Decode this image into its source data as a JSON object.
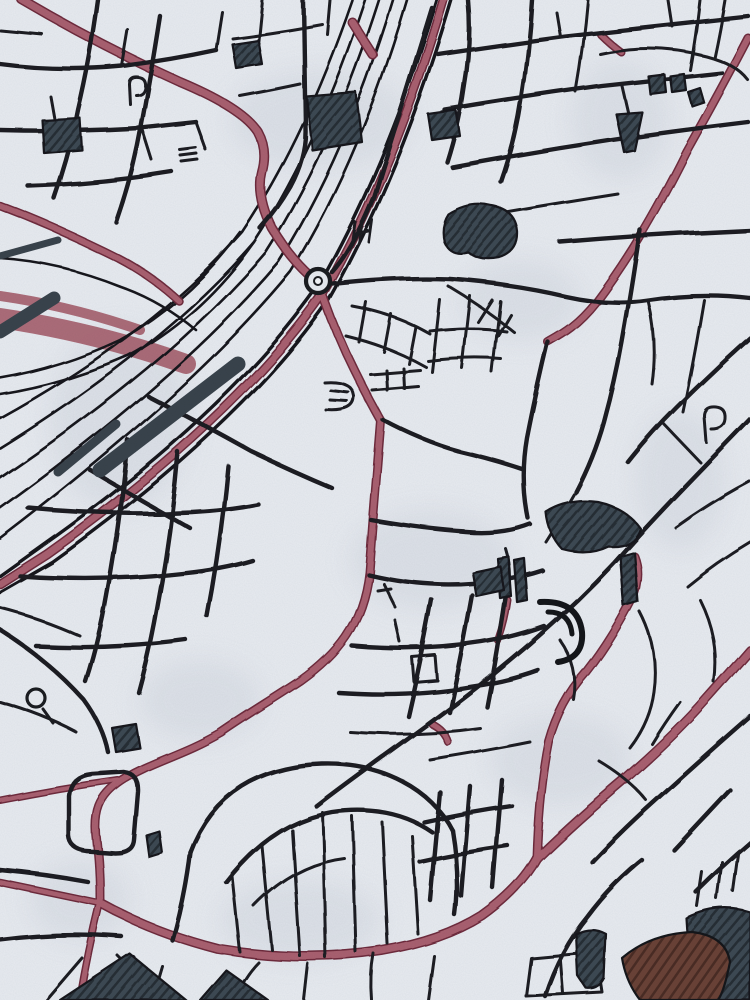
{
  "artwork": {
    "title": "watercolor-ink-city-street-map-art",
    "palette": {
      "paper": "#e8ebf0",
      "paper_shadow": "#bcc5d0",
      "ink": "#1a1c20",
      "rail_ink": "#17191d",
      "accent_road_fill": "#a9606f",
      "accent_road_casing": "#6e2c3c",
      "yard_red": "#a35a68",
      "dark_block": "#3d4852",
      "dark_block_hatch": "#252e36",
      "brown_block": "#6a4237",
      "brown_block_hatch": "#4a2c24"
    },
    "layers": [
      {
        "name": "paper-blotches",
        "kind": "ellipse",
        "fill": "#bcc5d0",
        "opacity": 0.26,
        "blur": true,
        "items": [
          {
            "cx": 320,
            "cy": 120,
            "rx": 90,
            "ry": 50
          },
          {
            "cx": 120,
            "cy": 420,
            "rx": 70,
            "ry": 90
          },
          {
            "cx": 520,
            "cy": 300,
            "rx": 60,
            "ry": 40
          },
          {
            "cx": 620,
            "cy": 120,
            "rx": 50,
            "ry": 60
          },
          {
            "cx": 430,
            "cy": 560,
            "rx": 80,
            "ry": 50
          },
          {
            "cx": 200,
            "cy": 700,
            "rx": 60,
            "ry": 40
          },
          {
            "cx": 560,
            "cy": 760,
            "rx": 70,
            "ry": 45
          },
          {
            "cx": 300,
            "cy": 920,
            "rx": 80,
            "ry": 40
          },
          {
            "cx": 680,
            "cy": 480,
            "rx": 45,
            "ry": 70
          },
          {
            "cx": 80,
            "cy": 900,
            "rx": 50,
            "ry": 40
          }
        ]
      },
      {
        "name": "railway-yard-red-band",
        "kind": "path",
        "stroke": "#a35a68",
        "opacity": 0.88,
        "items": [
          {
            "d": "M0,318 Q95,332 186,364",
            "w": 20
          },
          {
            "d": "M0,296 Q70,306 140,330",
            "w": 10
          }
        ]
      },
      {
        "name": "railway-tracks",
        "kind": "path",
        "stroke": "#17191d",
        "width": 2.6,
        "rough": true,
        "items": [
          {
            "d": "M352,0 Q304,140 242,232 Q152,334 0,418"
          },
          {
            "d": "M365,0 Q317,146 254,242 Q162,348 0,448"
          },
          {
            "d": "M379,0 Q331,151 266,252 Q172,362 0,478"
          },
          {
            "d": "M393,0 Q346,156 279,262 Q182,377 0,508"
          },
          {
            "d": "M407,0 Q360,161 291,272 Q192,392 0,538"
          },
          {
            "d": "M240,232 Q190,300 120,340 Q60,368 0,378"
          },
          {
            "d": "M254,242 Q200,318 128,356 Q64,384 0,394"
          },
          {
            "d": "M0,258 Q60,262 120,286 Q160,300 196,330"
          }
        ]
      },
      {
        "name": "highway-lines",
        "kind": "path",
        "stroke": "#17191d",
        "width": 3.4,
        "rough": true,
        "items": [
          {
            "d": "M437,0 Q386,170 316,290 Q226,416 42,546 L0,576"
          },
          {
            "d": "M452,0 Q400,176 328,302 Q240,428 52,562 L0,592"
          }
        ]
      },
      {
        "name": "red-roads",
        "kind": "path",
        "stroke": "#a9606f",
        "casing": {
          "stroke": "#6e2c3c",
          "extra": 3
        },
        "rough": true,
        "items": [
          {
            "d": "M444,0 Q393,173 322,296 Q233,422 47,554 L0,584",
            "w": 6.5
          },
          {
            "d": "M22,0 Q100,46 180,82 Q242,108 258,132 Q268,150 262,172 Q256,196 272,228 Q290,258 310,276",
            "w": 7
          },
          {
            "d": "M0,206 Q58,228 118,258 Q152,276 178,300",
            "w": 5.5
          },
          {
            "d": "M748,38 C722,88 704,120 686,152 C652,220 626,262 596,302 C577,326 562,334 548,342",
            "w": 6
          },
          {
            "d": "M100,903 Q152,932 218,949 Q302,963 382,951 Q442,941 482,916 Q520,889 537,858",
            "w": 7
          },
          {
            "d": "M537,858 Q576,820 626,778 Q676,734 706,700 Q731,672 750,650",
            "w": 7
          },
          {
            "d": "M100,903 Q58,894 0,882",
            "w": 4.5
          },
          {
            "d": "M100,903 Q88,952 80,1000",
            "w": 5
          },
          {
            "d": "M634,556 Q642,576 631,602 Q611,641 586,673 Q560,702 549,742 Q539,792 537,858",
            "w": 6
          },
          {
            "d": "M318,281 Q331,320 346,353 Q363,389 381,421",
            "w": 6
          },
          {
            "d": "M381,421 C376,480 373,520 369,572 C363,626 336,656 301,681 C271,701 250,713 221,733 C181,756 150,762 121,781 C99,796 93,812 97,843 C100,870 100,888 100,903",
            "w": 6
          },
          {
            "d": "M118,780 Q60,788 0,800",
            "w": 4
          },
          {
            "d": "M352,22 Q362,38 373,55",
            "w": 7
          },
          {
            "d": "M600,34 Q610,44 621,52",
            "w": 5
          },
          {
            "d": "M508,600 Q505,622 498,641",
            "w": 4
          },
          {
            "d": "M432,724 Q444,730 448,742",
            "w": 5
          }
        ]
      },
      {
        "name": "streets-major",
        "kind": "path",
        "stroke": "#1a1c20",
        "width": 4.4,
        "rough": true,
        "items": [
          {
            "d": "M98,0 Q90,60 78,110 Q70,152 54,198"
          },
          {
            "d": "M160,16 Q150,80 140,132 Q132,176 116,222"
          },
          {
            "d": "M0,64 Q60,72 122,66 Q170,60 216,50"
          },
          {
            "d": "M0,130 Q70,132 140,128 L196,122"
          },
          {
            "d": "M28,186 Q100,184 172,172"
          },
          {
            "d": "M303,0 L305,128 Q306,156 290,186 Q276,210 260,228"
          },
          {
            "d": "M432,8 Q405,95 374,196 Q352,250 332,272"
          },
          {
            "d": "M438,54 Q505,44 565,36 Q655,26 748,16"
          },
          {
            "d": "M445,110 Q522,97 602,86 Q665,79 722,73"
          },
          {
            "d": "M452,167 Q532,152 612,140 Q682,130 748,122"
          },
          {
            "d": "M468,0 Q472,42 464,88 Q459,124 447,162"
          },
          {
            "d": "M532,0 Q529,52 521,102 Q515,142 501,182"
          },
          {
            "d": "M560,242 Q655,234 750,230"
          },
          {
            "d": "M333,284 Q395,277 450,279 Q515,284 565,296 Q610,306 648,300 Q700,292 750,298"
          },
          {
            "d": "M548,342 Q536,392 527,438 Q520,478 528,518"
          },
          {
            "d": "M640,230 Q631,292 622,342 Q615,382 604,422 Q594,458 576,492"
          },
          {
            "d": "M750,418 C700,470 658,512 614,562 C558,622 498,672 438,716 C395,748 352,778 316,806"
          },
          {
            "d": "M750,338 Q712,372 676,408 Q650,434 628,462"
          },
          {
            "d": "M148,396 Q202,424 252,452 Q294,472 332,488"
          },
          {
            "d": "M128,440 Q121,522 107,596 Q99,642 86,682"
          },
          {
            "d": "M178,452 Q171,532 157,606 Q149,652 138,692"
          },
          {
            "d": "M228,466 Q221,542 207,616"
          },
          {
            "d": "M28,508 Q112,516 192,512 Q228,510 258,504"
          },
          {
            "d": "M20,576 Q102,582 182,573 Q222,569 252,560"
          },
          {
            "d": "M36,646 Q112,650 186,640"
          },
          {
            "d": "M0,630 Q48,660 84,700 Q103,726 108,752"
          },
          {
            "d": "M383,420 Q422,441 458,451 Q492,459 522,469"
          },
          {
            "d": "M371,520 Q422,529 466,532 Q502,535 530,524"
          },
          {
            "d": "M368,574 Q422,587 472,583 Q512,580 542,570"
          },
          {
            "d": "M352,646 Q420,652 482,642 Q514,637 544,626"
          },
          {
            "d": "M338,692 Q410,697 472,686 Q508,681 538,670"
          },
          {
            "d": "M432,600 Q421,660 408,716"
          },
          {
            "d": "M472,595 Q461,656 449,712"
          },
          {
            "d": "M507,588 Q498,650 487,707"
          },
          {
            "d": "M190,852 C212,792 262,766 322,764 C382,762 432,790 452,830"
          },
          {
            "d": "M226,882 Q272,822 332,812 Q392,804 432,832"
          },
          {
            "d": "M190,852 Q184,900 172,940"
          },
          {
            "d": "M452,830 Q460,878 455,915"
          },
          {
            "d": "M440,792 L430,900"
          },
          {
            "d": "M470,786 L461,896"
          },
          {
            "d": "M502,780 L493,888"
          },
          {
            "d": "M424,822 Q468,812 512,806"
          },
          {
            "d": "M420,862 Q464,852 508,846"
          },
          {
            "d": "M750,716 Q702,758 658,798 Q622,830 592,862"
          },
          {
            "d": "M730,790 Q702,820 674,850"
          },
          {
            "d": "M750,842 Q722,866 696,892"
          },
          {
            "d": "M545,996 Q560,950 588,916 Q612,884 642,860"
          },
          {
            "d": "M642,1000 Q662,960 696,930"
          },
          {
            "d": "M69,796 Q71,776 92,774 L124,772 Q139,774 138,792 L134,840 Q133,853 115,853 L86,851 Q70,849 69,836 Z"
          },
          {
            "d": "M0,870 Q45,874 88,882"
          },
          {
            "d": "M0,940 Q60,932 122,937"
          },
          {
            "d": "M90,470 Q140,500 190,528"
          }
        ]
      },
      {
        "name": "streets-minor",
        "kind": "path",
        "stroke": "#1a1c20",
        "width": 3,
        "rough": true,
        "items": [
          {
            "d": "M122,66 L128,30"
          },
          {
            "d": "M56,130 L50,96"
          },
          {
            "d": "M142,128 L152,160"
          },
          {
            "d": "M0,30 L42,34"
          },
          {
            "d": "M216,50 L222,12"
          },
          {
            "d": "M196,122 L206,150"
          },
          {
            "d": "M262,0 L258,40"
          },
          {
            "d": "M232,38 Q280,32 322,24"
          },
          {
            "d": "M240,96 Q272,90 300,84"
          },
          {
            "d": "M330,0 L327,34"
          },
          {
            "d": "M560,36 L556,12"
          },
          {
            "d": "M622,86 L628,112"
          },
          {
            "d": "M672,26 L668,0"
          },
          {
            "d": "M700,0 Q696,36 690,70"
          },
          {
            "d": "M725,0 Q720,30 714,58"
          },
          {
            "d": "M588,0 Q584,46 576,92"
          },
          {
            "d": "M600,54 Q652,42 706,56 Q736,64 748,80"
          },
          {
            "d": "M462,220 Q542,206 618,194"
          },
          {
            "d": "M352,306 Q396,314 430,334"
          },
          {
            "d": "M346,336 Q391,347 426,367"
          },
          {
            "d": "M366,302 L359,342"
          },
          {
            "d": "M391,314 L384,352"
          },
          {
            "d": "M416,327 L409,364"
          },
          {
            "d": "M440,300 L432,372"
          },
          {
            "d": "M470,296 L462,368"
          },
          {
            "d": "M500,301 L492,372"
          },
          {
            "d": "M430,331 Q470,326 506,331"
          },
          {
            "d": "M428,361 Q468,356 501,359"
          },
          {
            "d": "M370,374 L420,370"
          },
          {
            "d": "M372,390 L418,386"
          },
          {
            "d": "M386,370 L387,390"
          },
          {
            "d": "M403,368 L404,388"
          },
          {
            "d": "M324,382 Q352,380 354,396 Q355,412 326,410"
          },
          {
            "d": "M330,390 L348,392"
          },
          {
            "d": "M330,400 L347,401"
          },
          {
            "d": "M448,286 Q482,306 514,332"
          },
          {
            "d": "M492,300 L478,322"
          },
          {
            "d": "M510,314 L497,336"
          },
          {
            "d": "M704,300 Q694,360 683,412"
          },
          {
            "d": "M750,482 Q712,502 676,528"
          },
          {
            "d": "M750,542 Q716,562 687,586"
          },
          {
            "d": "M706,442 L704,416 Q704,406 716,407 Q726,408 725,419 Q724,429 711,429"
          },
          {
            "d": "M662,422 L700,462"
          },
          {
            "d": "M412,657 L414,682 L437,680 L435,655 Z"
          },
          {
            "d": "M395,620 L400,642"
          },
          {
            "d": "M350,732 Q418,737 480,728"
          },
          {
            "d": "M383,583 L395,607"
          },
          {
            "d": "M377,590 L390,588"
          },
          {
            "d": "M355,222 L352,244"
          },
          {
            "d": "M362,222 L359,244"
          },
          {
            "d": "M359,233 L368,231"
          },
          {
            "d": "M372,220 L369,242"
          },
          {
            "d": "M44,710 L54,724"
          },
          {
            "d": "M0,702 Q42,714 76,732"
          },
          {
            "d": "M232,876 L240,952"
          },
          {
            "d": "M262,846 L272,950"
          },
          {
            "d": "M292,830 L300,956"
          },
          {
            "d": "M322,812 L326,958"
          },
          {
            "d": "M352,816 L356,952"
          },
          {
            "d": "M382,822 L388,944"
          },
          {
            "d": "M412,836 L418,934"
          },
          {
            "d": "M254,906 Q294,864 344,858"
          },
          {
            "d": "M46,1000 L82,958"
          },
          {
            "d": "M152,1000 L162,966"
          },
          {
            "d": "M234,1000 Q244,976 258,962"
          },
          {
            "d": "M304,1000 L308,964"
          },
          {
            "d": "M372,1000 Q370,976 374,954"
          },
          {
            "d": "M428,1000 L434,956"
          },
          {
            "d": "M526,996 L531,958 L596,952 L602,992 Z"
          },
          {
            "d": "M560,955 L563,993"
          },
          {
            "d": "M702,872 L697,906"
          },
          {
            "d": "M722,862 L717,899"
          },
          {
            "d": "M738,854 L733,891"
          },
          {
            "d": "M680,702 Q664,724 652,744"
          },
          {
            "d": "M600,762 Q630,780 646,800"
          },
          {
            "d": "M118,956 L140,978"
          },
          {
            "d": "M120,968 L134,957"
          },
          {
            "d": "M127,975 L141,964"
          },
          {
            "d": "M134,982 L148,971"
          },
          {
            "d": "M130,104 L129,84 Q129,76 138,77 Q146,78 145,87 Q144,95 136,95"
          },
          {
            "d": "M180,150 L196,148"
          },
          {
            "d": "M181,156 L197,154"
          },
          {
            "d": "M182,162 L198,160"
          },
          {
            "d": "M0,608 Q40,618 80,636"
          },
          {
            "d": "M640,612 Q660,650 654,692 Q650,722 630,748"
          },
          {
            "d": "M700,600 Q720,640 714,682"
          },
          {
            "d": "M560,640 Q580,668 574,700"
          },
          {
            "d": "M430,760 Q480,752 530,742"
          },
          {
            "d": "M505,548 Q512,570 508,592"
          },
          {
            "d": "M576,492 Q560,520 546,542"
          },
          {
            "d": "M648,300 Q658,342 652,384"
          }
        ]
      },
      {
        "name": "station-platform-strips",
        "kind": "path",
        "stroke": "#39434c",
        "items": [
          {
            "d": "M100,470 L238,364",
            "w": 15
          },
          {
            "d": "M58,472 L116,424",
            "w": 9
          },
          {
            "d": "M0,332 L54,298",
            "w": 13
          },
          {
            "d": "M0,256 L58,240",
            "w": 7
          }
        ]
      },
      {
        "name": "dark-blocks",
        "kind": "shape",
        "fill": "url(#hatch-slate)",
        "stroke": "#14161a",
        "width": 2.2,
        "rough": true,
        "items": [
          {
            "d": "M306,96 L356,92 L362,142 L312,150"
          },
          {
            "d": "M428,114 L456,110 L460,136 L432,140"
          },
          {
            "d": "M42,120 L80,118 L82,150 L44,153"
          },
          {
            "d": "M232,44 L258,40 L262,64 L236,68"
          },
          {
            "d": "M448,214 Q470,200 492,206 Q516,210 518,232 Q519,252 500,258 Q480,262 468,252 Q450,256 444,242 Q440,226 448,214"
          },
          {
            "d": "M648,76 L664,74 L666,92 L650,94"
          },
          {
            "d": "M670,76 L684,74 L686,90 L672,92"
          },
          {
            "d": "M688,92 L700,88 L704,102 L692,106"
          },
          {
            "d": "M616,114 L642,112 L634,150 L624,152"
          },
          {
            "d": "M546,512 Q568,498 598,502 Q626,508 640,528 Q634,548 608,546 Q588,556 562,549 Q548,534 546,512"
          },
          {
            "d": "M620,556 L634,552 L638,602 L624,606"
          },
          {
            "d": "M497,558 L508,556 L511,596 L500,598"
          },
          {
            "d": "M514,560 L524,558 L527,600 L517,602"
          },
          {
            "d": "M472,572 L500,566 L504,590 L476,596"
          },
          {
            "d": "M60,1000 L130,954 L186,1000"
          },
          {
            "d": "M200,1000 L226,970 L268,1000"
          },
          {
            "d": "M576,934 Q592,926 606,934 L604,978 Q598,990 586,988 L578,976"
          },
          {
            "d": "M686,918 Q718,902 750,912 L750,1000 L700,1000 Q688,960 686,918"
          },
          {
            "d": "M112,728 L136,724 L140,748 L116,752"
          },
          {
            "d": "M147,836 L160,832 L163,854 L150,858"
          }
        ]
      },
      {
        "name": "park-crescents",
        "kind": "path",
        "stroke": "#14161a",
        "items": [
          {
            "d": "M540,602 Q578,600 582,632 Q584,658 558,662",
            "w": 6
          },
          {
            "d": "M548,612 Q570,612 572,634",
            "w": 5
          }
        ]
      },
      {
        "name": "brown-blocks",
        "kind": "shape",
        "fill": "url(#hatch-brown)",
        "stroke": "#14161a",
        "width": 2.2,
        "items": [
          {
            "d": "M622,958 Q650,934 692,932 Q726,936 730,962 Q724,992 718,1000 L640,1000 Q626,982 622,958"
          }
        ]
      },
      {
        "name": "roundabout-and-loops",
        "kind": "circle",
        "items": [
          {
            "cx": 318,
            "cy": 281,
            "r": 12,
            "fill": "#e8ebf0",
            "stroke": "#1a1c20",
            "w": 4.2
          },
          {
            "cx": 318,
            "cy": 281,
            "r": 4,
            "fill": "#f2f4f7",
            "stroke": "#1a1c20",
            "w": 2
          },
          {
            "cx": 36,
            "cy": 698,
            "r": 9,
            "fill": "none",
            "stroke": "#1a1c20",
            "w": 3.2
          }
        ]
      }
    ]
  }
}
